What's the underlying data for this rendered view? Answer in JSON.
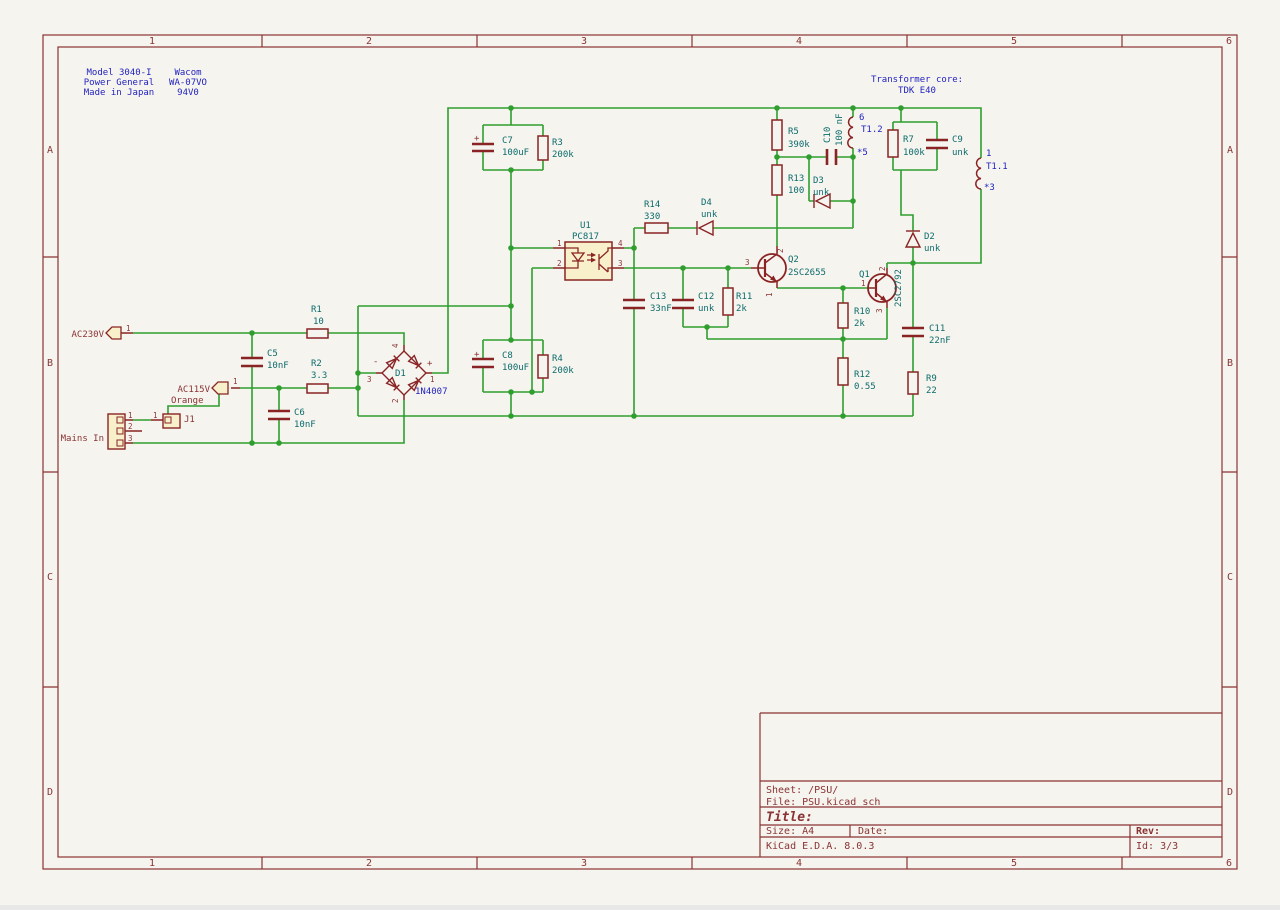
{
  "colors": {
    "bg": "#f5f4ef",
    "wire": "#2f9e2f",
    "symbol": "#8a2424",
    "fill": "#f8f0cb",
    "teal": "#0d6b6b",
    "blue": "#2323c0",
    "red": "#8a3333",
    "border": "#8a3333"
  },
  "title_block": {
    "sheet": "Sheet: /PSU/",
    "file": "File: PSU.kicad_sch",
    "title": "Title:",
    "size": "Size: A4",
    "date": "Date:",
    "rev": "Rev:",
    "tool": "KiCad E.D.A. 8.0.3",
    "id": "Id: 3/3"
  },
  "border": {
    "cols": [
      {
        "label": "1",
        "x": 152
      },
      {
        "label": "2",
        "x": 369
      },
      {
        "label": "3",
        "x": 584
      },
      {
        "label": "4",
        "x": 799
      },
      {
        "label": "5",
        "x": 1014
      },
      {
        "label": "6",
        "x": 1229
      }
    ],
    "col_y_top": 44,
    "col_y_bottom": 866,
    "rows": [
      {
        "label": "A",
        "y": 153
      },
      {
        "label": "B",
        "y": 366
      },
      {
        "label": "C",
        "y": 580
      },
      {
        "label": "D",
        "y": 795
      }
    ],
    "row_x_left": 50,
    "row_x_right": 1230
  },
  "schematic": {
    "texts": [
      {
        "n": "note-model-1",
        "t": "Model 3040-I",
        "x": 119,
        "y": 75,
        "c": "b",
        "a": "m"
      },
      {
        "n": "note-model-2",
        "t": "Power General",
        "x": 119,
        "y": 85,
        "c": "b",
        "a": "m"
      },
      {
        "n": "note-model-3",
        "t": "Made in Japan",
        "x": 119,
        "y": 95,
        "c": "b",
        "a": "m"
      },
      {
        "n": "note-vendor-1",
        "t": "Wacom",
        "x": 188,
        "y": 75,
        "c": "b",
        "a": "m"
      },
      {
        "n": "note-vendor-2",
        "t": "WA-07VO",
        "x": 188,
        "y": 85,
        "c": "b",
        "a": "m"
      },
      {
        "n": "note-vendor-3",
        "t": "94V0",
        "x": 188,
        "y": 95,
        "c": "b",
        "a": "m"
      },
      {
        "n": "note-transformer-1",
        "t": "Transformer core:",
        "x": 917,
        "y": 82,
        "c": "b",
        "a": "m"
      },
      {
        "n": "note-transformer-2",
        "t": "TDK E40",
        "x": 917,
        "y": 93,
        "c": "b",
        "a": "m"
      },
      {
        "n": "netlabel-ac230v",
        "t": "AC230V",
        "x": 104,
        "y": 337,
        "c": "r",
        "a": "e"
      },
      {
        "n": "pin-ac230v-1",
        "t": "1",
        "x": 126,
        "y": 331,
        "c": "r",
        "s": 7.5
      },
      {
        "n": "ref-r1",
        "t": "R1",
        "x": 311,
        "y": 312
      },
      {
        "n": "val-r1",
        "t": "10",
        "x": 313,
        "y": 324
      },
      {
        "n": "ref-c5",
        "t": "C5",
        "x": 267,
        "y": 356
      },
      {
        "n": "val-c5",
        "t": "10nF",
        "x": 267,
        "y": 368
      },
      {
        "n": "ref-r2",
        "t": "R2",
        "x": 311,
        "y": 366
      },
      {
        "n": "val-r2",
        "t": "3.3",
        "x": 311,
        "y": 378
      },
      {
        "n": "ref-c6",
        "t": "C6",
        "x": 294,
        "y": 415
      },
      {
        "n": "val-c6",
        "t": "10nF",
        "x": 294,
        "y": 427
      },
      {
        "n": "netlabel-ac115v",
        "t": "AC115V",
        "x": 210,
        "y": 392,
        "c": "r",
        "a": "e"
      },
      {
        "n": "pin-ac115v-1",
        "t": "1",
        "x": 233,
        "y": 384,
        "c": "r",
        "s": 7.5
      },
      {
        "n": "netlabel-orange",
        "t": "Orange",
        "x": 171,
        "y": 403,
        "c": "r"
      },
      {
        "n": "ref-j1",
        "t": "J1",
        "x": 184,
        "y": 422,
        "c": "r"
      },
      {
        "n": "pin-j1-1",
        "t": "1",
        "x": 153,
        "y": 418,
        "c": "r",
        "s": 7.5
      },
      {
        "n": "label-mains-in",
        "t": "Mains In",
        "x": 104,
        "y": 441,
        "c": "r",
        "a": "e"
      },
      {
        "n": "pin-mains-1",
        "t": "1",
        "x": 128,
        "y": 418,
        "c": "r",
        "s": 7.5
      },
      {
        "n": "pin-mains-2",
        "t": "2",
        "x": 128,
        "y": 429,
        "c": "r",
        "s": 7.5
      },
      {
        "n": "pin-mains-3",
        "t": "3",
        "x": 128,
        "y": 441,
        "c": "r",
        "s": 7.5
      },
      {
        "n": "ref-d1",
        "t": "D1",
        "x": 395,
        "y": 376
      },
      {
        "n": "val-d1",
        "t": "1N4007",
        "x": 415,
        "y": 394,
        "c": "b"
      },
      {
        "n": "sym-d1-plus",
        "t": "+",
        "x": 427,
        "y": 366,
        "c": "r"
      },
      {
        "n": "sym-d1-minus",
        "t": "-",
        "x": 373,
        "y": 364,
        "c": "r"
      },
      {
        "n": "pin-d1-4",
        "t": "4",
        "x": 398,
        "y": 348,
        "c": "r",
        "s": 7.5,
        "r": -90
      },
      {
        "n": "pin-d1-3",
        "t": "3",
        "x": 367,
        "y": 382,
        "c": "r",
        "s": 7.5
      },
      {
        "n": "pin-d1-1",
        "t": "1",
        "x": 430,
        "y": 382,
        "c": "r",
        "s": 7.5
      },
      {
        "n": "pin-d1-2",
        "t": "2",
        "x": 398,
        "y": 403,
        "c": "r",
        "s": 7.5,
        "r": -90
      },
      {
        "n": "ref-c7",
        "t": "C7",
        "x": 502,
        "y": 143
      },
      {
        "n": "val-c7",
        "t": "100uF",
        "x": 502,
        "y": 155
      },
      {
        "n": "sym-c7-plus",
        "t": "+",
        "x": 474,
        "y": 141,
        "c": "r"
      },
      {
        "n": "ref-r3",
        "t": "R3",
        "x": 552,
        "y": 145
      },
      {
        "n": "val-r3",
        "t": "200k",
        "x": 552,
        "y": 157
      },
      {
        "n": "ref-c8",
        "t": "C8",
        "x": 502,
        "y": 358
      },
      {
        "n": "val-c8",
        "t": "100uF",
        "x": 502,
        "y": 370
      },
      {
        "n": "sym-c8-plus",
        "t": "+",
        "x": 474,
        "y": 357,
        "c": "r"
      },
      {
        "n": "ref-r4",
        "t": "R4",
        "x": 552,
        "y": 361
      },
      {
        "n": "val-r4",
        "t": "200k",
        "x": 552,
        "y": 373
      },
      {
        "n": "ref-u1",
        "t": "U1",
        "x": 580,
        "y": 228
      },
      {
        "n": "val-u1",
        "t": "PC817",
        "x": 572,
        "y": 239
      },
      {
        "n": "pin-u1-1",
        "t": "1",
        "x": 557,
        "y": 246,
        "c": "r",
        "s": 7.5
      },
      {
        "n": "pin-u1-2",
        "t": "2",
        "x": 557,
        "y": 266,
        "c": "r",
        "s": 7.5
      },
      {
        "n": "pin-u1-4",
        "t": "4",
        "x": 618,
        "y": 246,
        "c": "r",
        "s": 7.5
      },
      {
        "n": "pin-u1-3",
        "t": "3",
        "x": 618,
        "y": 266,
        "c": "r",
        "s": 7.5
      },
      {
        "n": "ref-r14",
        "t": "R14",
        "x": 644,
        "y": 207
      },
      {
        "n": "val-r14",
        "t": "330",
        "x": 644,
        "y": 219
      },
      {
        "n": "ref-d4",
        "t": "D4",
        "x": 701,
        "y": 205
      },
      {
        "n": "val-d4",
        "t": "unk",
        "x": 701,
        "y": 217
      },
      {
        "n": "ref-c13",
        "t": "C13",
        "x": 650,
        "y": 299
      },
      {
        "n": "val-c13",
        "t": "33nF",
        "x": 650,
        "y": 311
      },
      {
        "n": "ref-c12",
        "t": "C12",
        "x": 698,
        "y": 299
      },
      {
        "n": "val-c12",
        "t": "unk",
        "x": 698,
        "y": 311
      },
      {
        "n": "ref-r11",
        "t": "R11",
        "x": 736,
        "y": 299
      },
      {
        "n": "val-r11",
        "t": "2k",
        "x": 736,
        "y": 311
      },
      {
        "n": "ref-q2",
        "t": "Q2",
        "x": 788,
        "y": 262
      },
      {
        "n": "val-q2",
        "t": "2SC2655",
        "x": 788,
        "y": 275
      },
      {
        "n": "pin-q2-3",
        "t": "3",
        "x": 745,
        "y": 265,
        "c": "r",
        "s": 7.5
      },
      {
        "n": "pin-q2-2",
        "t": "2",
        "x": 783,
        "y": 253,
        "c": "r",
        "s": 7.5,
        "r": -90
      },
      {
        "n": "pin-q2-1",
        "t": "1",
        "x": 772,
        "y": 297,
        "c": "r",
        "s": 7.5,
        "r": -90
      },
      {
        "n": "ref-r5",
        "t": "R5",
        "x": 788,
        "y": 134
      },
      {
        "n": "val-r5",
        "t": "390k",
        "x": 788,
        "y": 147
      },
      {
        "n": "ref-r13",
        "t": "R13",
        "x": 788,
        "y": 181
      },
      {
        "n": "val-r13",
        "t": "100",
        "x": 788,
        "y": 193
      },
      {
        "n": "ref-c10",
        "t": "C10",
        "x": 830,
        "y": 143,
        "r": -90
      },
      {
        "n": "val-c10",
        "t": "100 nF",
        "x": 842,
        "y": 146,
        "r": -90
      },
      {
        "n": "ref-d3",
        "t": "D3",
        "x": 813,
        "y": 183
      },
      {
        "n": "val-d3",
        "t": "unk",
        "x": 813,
        "y": 195
      },
      {
        "n": "pin-t12-6",
        "t": "6",
        "x": 859,
        "y": 120,
        "c": "b"
      },
      {
        "n": "ref-t12",
        "t": "T1.2",
        "x": 861,
        "y": 132,
        "c": "b"
      },
      {
        "n": "pin-t12-5",
        "t": "*5",
        "x": 857,
        "y": 155,
        "c": "b"
      },
      {
        "n": "ref-r7",
        "t": "R7",
        "x": 903,
        "y": 142
      },
      {
        "n": "val-r7",
        "t": "100k",
        "x": 903,
        "y": 155
      },
      {
        "n": "ref-c9",
        "t": "C9",
        "x": 952,
        "y": 142
      },
      {
        "n": "val-c9",
        "t": "unk",
        "x": 952,
        "y": 155
      },
      {
        "n": "pin-t11-1",
        "t": "1",
        "x": 986,
        "y": 156,
        "c": "b"
      },
      {
        "n": "ref-t11",
        "t": "T1.1",
        "x": 986,
        "y": 169,
        "c": "b"
      },
      {
        "n": "pin-t11-3",
        "t": "*3",
        "x": 984,
        "y": 190,
        "c": "b"
      },
      {
        "n": "ref-d2",
        "t": "D2",
        "x": 924,
        "y": 239
      },
      {
        "n": "val-d2",
        "t": "unk",
        "x": 924,
        "y": 251
      },
      {
        "n": "ref-q1",
        "t": "Q1",
        "x": 859,
        "y": 277
      },
      {
        "n": "val-q1",
        "t": "2SC2792",
        "x": 901,
        "y": 307,
        "r": -90
      },
      {
        "n": "pin-q1-1",
        "t": "1",
        "x": 861,
        "y": 286,
        "c": "r",
        "s": 7.5
      },
      {
        "n": "pin-q1-2",
        "t": "2",
        "x": 885,
        "y": 271,
        "c": "r",
        "s": 7.5,
        "r": -90
      },
      {
        "n": "pin-q1-3",
        "t": "3",
        "x": 882,
        "y": 313,
        "c": "r",
        "s": 7.5,
        "r": -90
      },
      {
        "n": "ref-r10",
        "t": "R10",
        "x": 854,
        "y": 314
      },
      {
        "n": "val-r10",
        "t": "2k",
        "x": 854,
        "y": 326
      },
      {
        "n": "ref-c11",
        "t": "C11",
        "x": 929,
        "y": 331
      },
      {
        "n": "val-c11",
        "t": "22nF",
        "x": 929,
        "y": 343
      },
      {
        "n": "ref-r12",
        "t": "R12",
        "x": 854,
        "y": 377
      },
      {
        "n": "val-r12",
        "t": "0.55",
        "x": 854,
        "y": 389
      },
      {
        "n": "ref-r9",
        "t": "R9",
        "x": 926,
        "y": 381
      },
      {
        "n": "val-r9",
        "t": "22",
        "x": 926,
        "y": 393
      }
    ]
  }
}
